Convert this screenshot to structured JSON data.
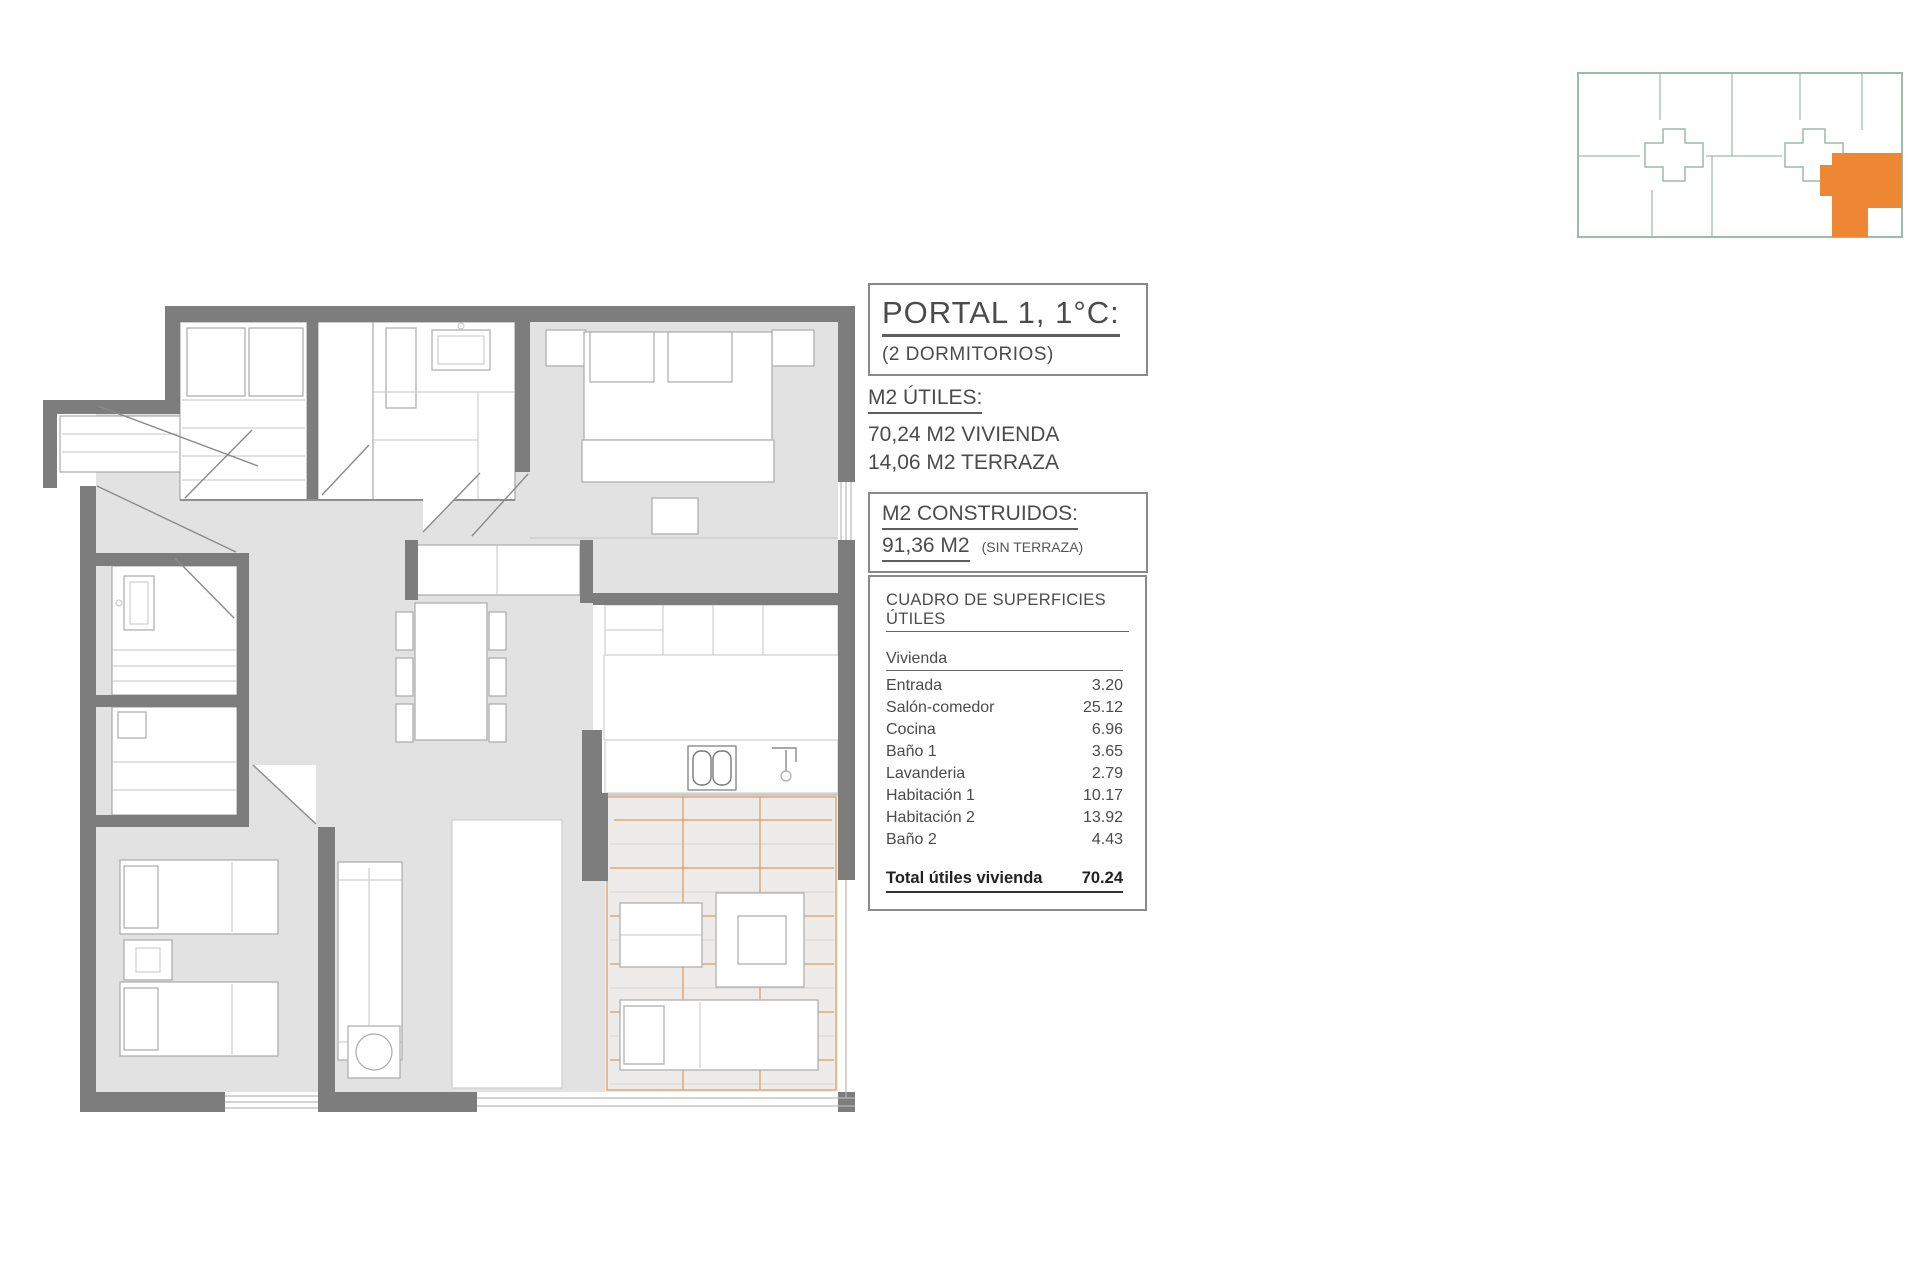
{
  "colors": {
    "accent-orange": "#ED8734",
    "terrace-line-orange": "#DD9A5E",
    "wall-gray": "#7D7D7D",
    "floor-gray": "#E2E2E2",
    "miniplan-teal": "#9CBCAB",
    "text-gray": "#4B4B4B"
  },
  "unit_header": {
    "title": "PORTAL 1, 1°C:",
    "subtitle": "(2 DORMITORIOS)"
  },
  "m2_utiles": {
    "heading": "M2 ÚTILES:",
    "line1": "70,24 M2 VIVIENDA",
    "line2": "14,06 M2 TERRAZA"
  },
  "m2_construidos": {
    "heading": "M2 CONSTRUIDOS:",
    "value": "91,36 M2",
    "note": "(SIN TERRAZA)"
  },
  "surfaces_table": {
    "title": "CUADRO DE SUPERFICIES ÚTILES",
    "group_header": "Vivienda",
    "rows": [
      {
        "label": "Entrada",
        "value": "3.20"
      },
      {
        "label": "Salón-comedor",
        "value": "25.12"
      },
      {
        "label": "Cocina",
        "value": "6.96"
      },
      {
        "label": "Baño 1",
        "value": "3.65"
      },
      {
        "label": "Lavanderia",
        "value": "2.79"
      },
      {
        "label": "Habitación 1",
        "value": "10.17"
      },
      {
        "label": "Habitación 2",
        "value": "13.92"
      },
      {
        "label": "Baño 2",
        "value": "4.43"
      }
    ],
    "total": {
      "label": "Total útiles vivienda",
      "value": "70.24"
    }
  }
}
